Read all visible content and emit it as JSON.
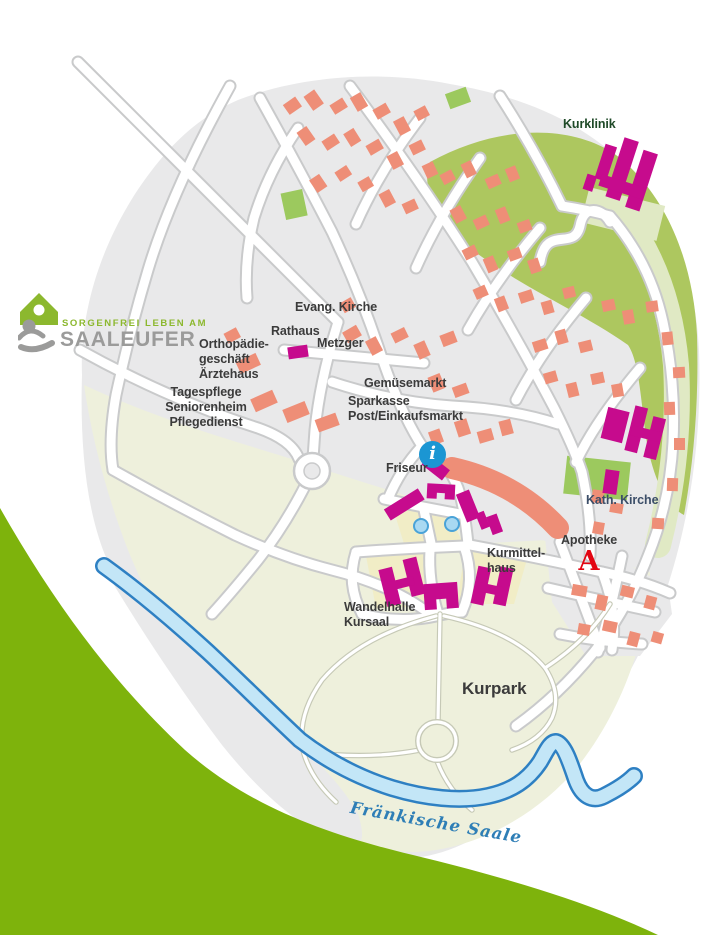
{
  "palette": {
    "map_gray": "#e9e9ea",
    "road_casing": "#c9cacb",
    "path_casing": "#c6c9b6",
    "building_salmon": "#ee8e77",
    "landmark_magenta": "#c60b8d",
    "park_olive": "#adc75f",
    "park_light": "#e0e9c4",
    "park_patch": "#9cc95e",
    "kurpark_cream": "#eef0dc",
    "plaza_yellow": "#f1edc6",
    "meadow_green": "#7eb30c",
    "river_fill": "#c3e6f7",
    "river_edge": "#2e80c3",
    "info_blue": "#1b96d3",
    "apotheke_red": "#e30613",
    "label_dark": "#3b3b3b",
    "label_green": "#1f4a28",
    "label_navy": "#3c4e68",
    "river_label": "#2e7eb6",
    "logo_green": "#8cb82e",
    "logo_gray": "#9b9b9a"
  },
  "logo": {
    "tagline": "SORGENFREI LEBEN AM",
    "brand": "SAALEUFER"
  },
  "labels": {
    "kurklinik": "Kurklinik",
    "evang_kirche": "Evang. Kirche",
    "rathaus": "Rathaus",
    "metzger": "Metzger",
    "orthopaedie": "Orthopädie-\ngeschäft\nÄrztehaus",
    "tagespflege": "Tagespflege\nSeniorenheim\nPflegedienst",
    "gemuesemarkt": "Gemüsemarkt",
    "sparkasse": "Sparkasse\nPost/Einkaufsmarkt",
    "friseur": "Friseur",
    "kath_kirche": "Kath. Kirche",
    "apotheke": "Apotheke",
    "kurmittelhaus": "Kurmittel-\nhaus",
    "wandelhalle": "Wandelhalle\nKursaal",
    "kurpark": "Kurpark",
    "river": "Fränkische Saale"
  },
  "icons": {
    "info_glyph": "i",
    "apotheke_glyph": "A"
  }
}
